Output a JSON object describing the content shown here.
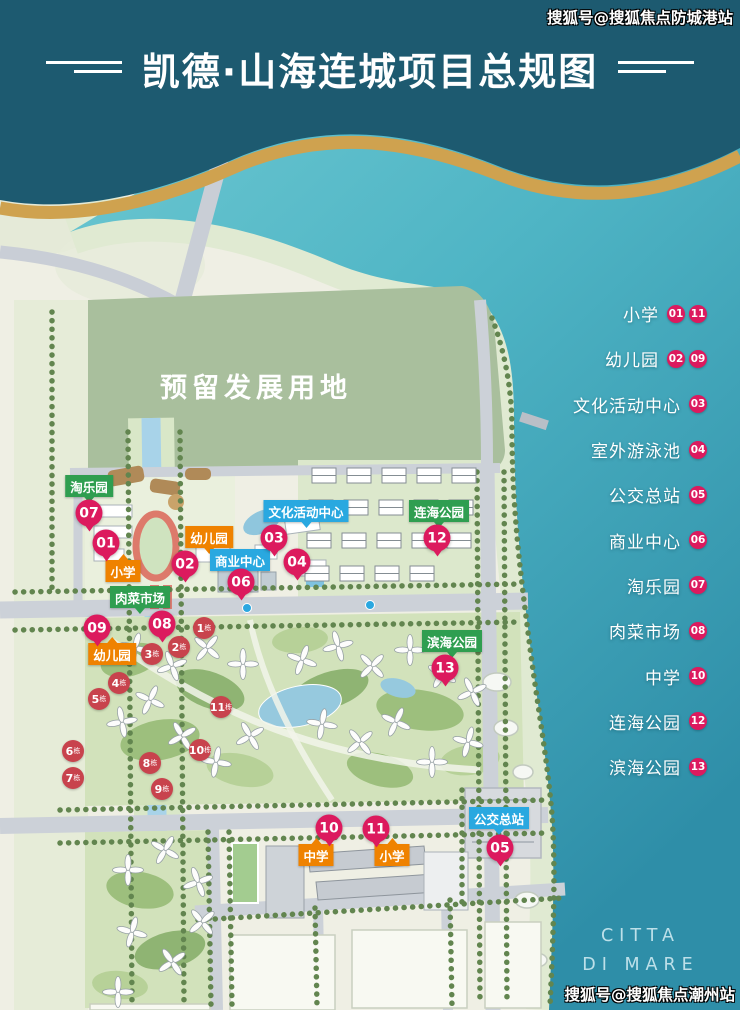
{
  "header": {
    "title": "凯德·山海连城项目总规图"
  },
  "watermarks": {
    "top_right": "搜狐号@搜狐焦点防城港站",
    "bottom_right": "搜狐号@搜狐焦点潮州站"
  },
  "legend": {
    "items": [
      {
        "label": "小学",
        "badges": [
          "01",
          "11"
        ]
      },
      {
        "label": "幼儿园",
        "badges": [
          "02",
          "09"
        ]
      },
      {
        "label": "文化活动中心",
        "badges": [
          "03"
        ]
      },
      {
        "label": "室外游泳池",
        "badges": [
          "04"
        ]
      },
      {
        "label": "公交总站",
        "badges": [
          "05"
        ]
      },
      {
        "label": "商业中心",
        "badges": [
          "06"
        ]
      },
      {
        "label": "淘乐园",
        "badges": [
          "07"
        ]
      },
      {
        "label": "肉菜市场",
        "badges": [
          "08"
        ]
      },
      {
        "label": "中学",
        "badges": [
          "10"
        ]
      },
      {
        "label": "连海公园",
        "badges": [
          "12"
        ]
      },
      {
        "label": "滨海公园",
        "badges": [
          "13"
        ]
      }
    ]
  },
  "map": {
    "reserved_area_label": "预留发展用地",
    "sea_caption": {
      "line1": "CITTA",
      "line2": "DI MARE"
    },
    "place_labels": [
      {
        "text": "淘乐园",
        "category": "park",
        "x": 89,
        "y": 486,
        "tail": "down"
      },
      {
        "text": "小学",
        "category": "school",
        "x": 123,
        "y": 571,
        "tail": "up"
      },
      {
        "text": "幼儿园",
        "category": "school",
        "x": 209,
        "y": 537,
        "tail": "down"
      },
      {
        "text": "商业中心",
        "category": "commercial",
        "x": 240,
        "y": 560,
        "tail": "down"
      },
      {
        "text": "文化活动中心",
        "category": "commercial",
        "x": 306,
        "y": 511,
        "tail": "down"
      },
      {
        "text": "连海公园",
        "category": "park",
        "x": 439,
        "y": 511,
        "tail": "down"
      },
      {
        "text": "肉菜市场",
        "category": "park",
        "x": 140,
        "y": 597,
        "tail": "down"
      },
      {
        "text": "幼儿园",
        "category": "school",
        "x": 112,
        "y": 654,
        "tail": "up"
      },
      {
        "text": "滨海公园",
        "category": "park",
        "x": 452,
        "y": 641,
        "tail": "down"
      },
      {
        "text": "中学",
        "category": "school",
        "x": 316,
        "y": 855,
        "tail": "up"
      },
      {
        "text": "小学",
        "category": "school",
        "x": 392,
        "y": 855,
        "tail": "up"
      },
      {
        "text": "公交总站",
        "category": "commercial",
        "x": 499,
        "y": 818,
        "tail": "down"
      }
    ],
    "markers": [
      {
        "num": "07",
        "x": 89,
        "y": 513
      },
      {
        "num": "01",
        "x": 106,
        "y": 543
      },
      {
        "num": "02",
        "x": 185,
        "y": 564
      },
      {
        "num": "06",
        "x": 241,
        "y": 582
      },
      {
        "num": "03",
        "x": 274,
        "y": 538
      },
      {
        "num": "04",
        "x": 297,
        "y": 562
      },
      {
        "num": "12",
        "x": 437,
        "y": 538
      },
      {
        "num": "08",
        "x": 162,
        "y": 624
      },
      {
        "num": "09",
        "x": 97,
        "y": 628
      },
      {
        "num": "13",
        "x": 445,
        "y": 668
      },
      {
        "num": "10",
        "x": 329,
        "y": 828
      },
      {
        "num": "11",
        "x": 376,
        "y": 829
      },
      {
        "num": "05",
        "x": 500,
        "y": 848
      }
    ],
    "building_badges": [
      {
        "num": "1",
        "suffix": "栋",
        "x": 204,
        "y": 628
      },
      {
        "num": "2",
        "suffix": "栋",
        "x": 179,
        "y": 647
      },
      {
        "num": "3",
        "suffix": "栋",
        "x": 152,
        "y": 654
      },
      {
        "num": "4",
        "suffix": "栋",
        "x": 119,
        "y": 683
      },
      {
        "num": "5",
        "suffix": "栋",
        "x": 99,
        "y": 699
      },
      {
        "num": "6",
        "suffix": "栋",
        "x": 73,
        "y": 751
      },
      {
        "num": "7",
        "suffix": "栋",
        "x": 73,
        "y": 778
      },
      {
        "num": "8",
        "suffix": "栋",
        "x": 150,
        "y": 763
      },
      {
        "num": "9",
        "suffix": "栋",
        "x": 162,
        "y": 789
      },
      {
        "num": "10",
        "suffix": "栋",
        "x": 200,
        "y": 750
      },
      {
        "num": "11",
        "suffix": "栋",
        "x": 221,
        "y": 707
      }
    ]
  },
  "colors": {
    "header_bg": "#1d5a70",
    "gold": "#cfa24f",
    "badge": "#dc1a5e",
    "building_badge": "#c8434d",
    "label_school": "#ef8200",
    "label_commercial": "#29a8e0",
    "label_park": "#2f9e50",
    "ocean": "#4fb5c5",
    "land": "#efefe4",
    "reserved_area": "#a9bf9d"
  }
}
